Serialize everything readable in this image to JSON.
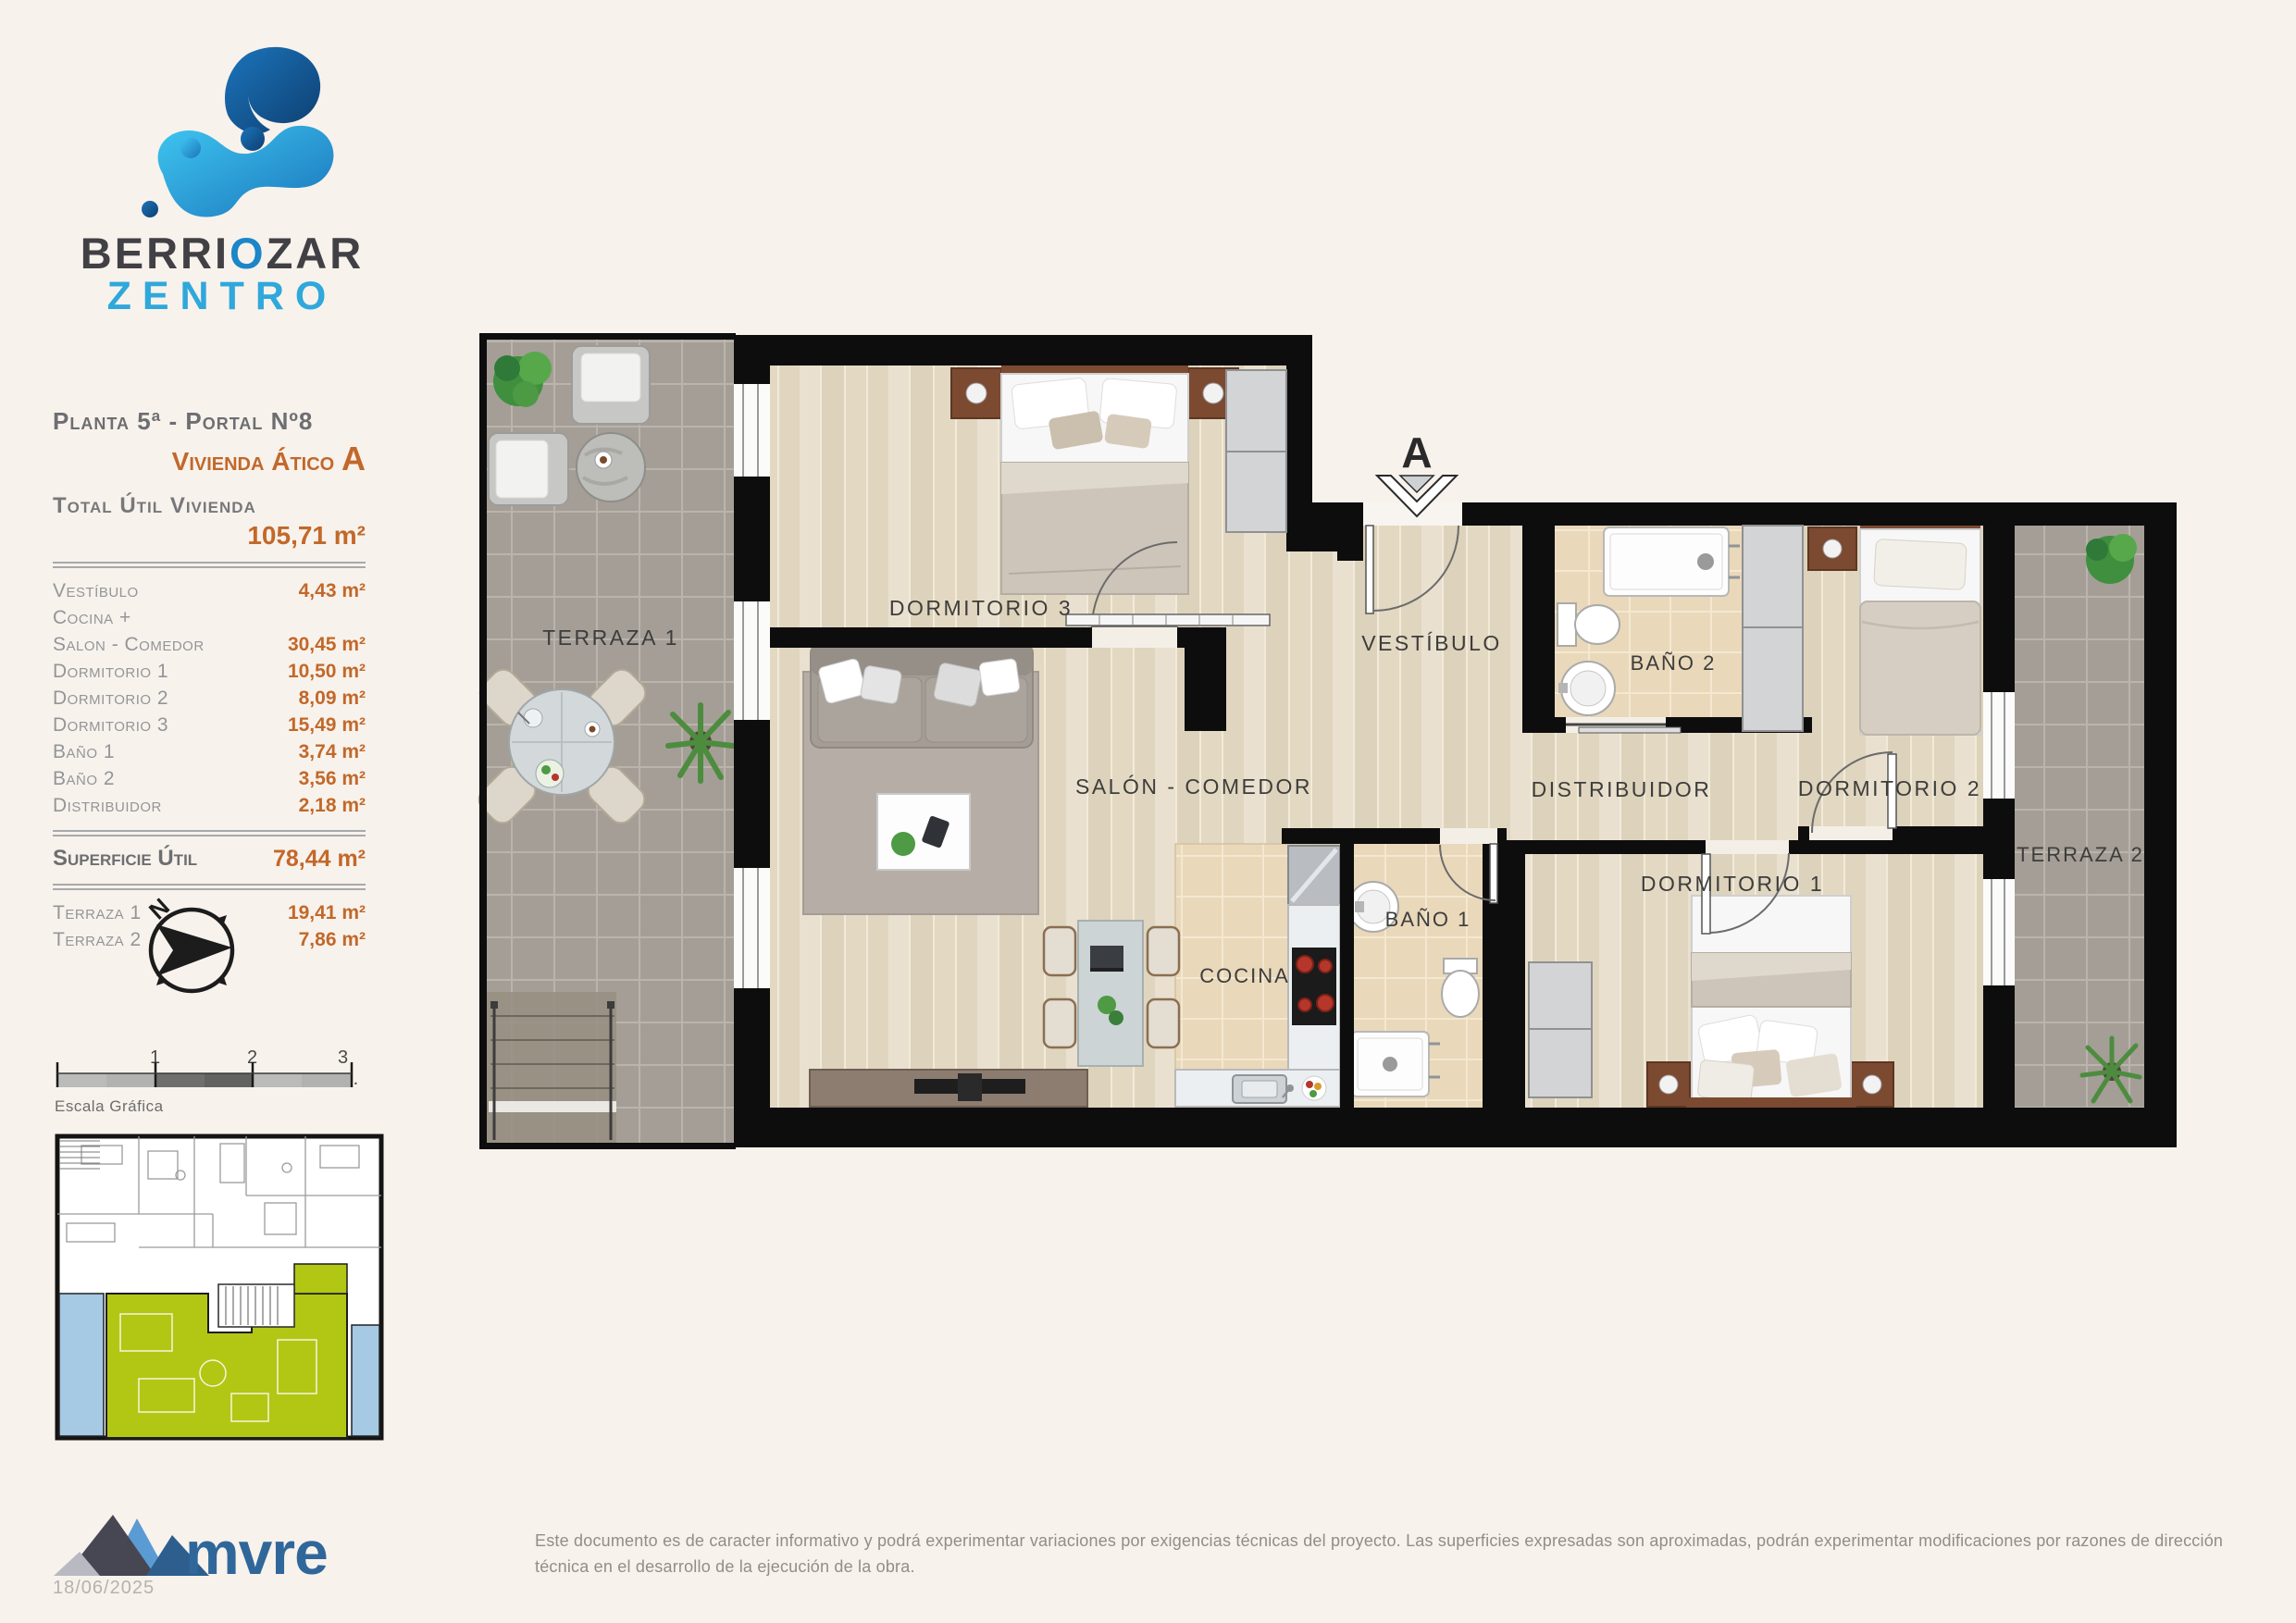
{
  "logo": {
    "line1_pre": "BERRI",
    "line1_o": "O",
    "line1_post": "ZAR",
    "line2": "ZENTRO"
  },
  "info": {
    "planta": "Planta 5ª - Portal Nº8",
    "vivienda": "Vivienda Ático ",
    "vivienda_letter": "A",
    "total_label": "Total Útil Vivienda",
    "total_value": "105,71 m²",
    "rows": [
      {
        "label": "Vestíbulo",
        "value": "4,43 m²"
      },
      {
        "label": "Cocina +",
        "value": ""
      },
      {
        "label": "Salon - Comedor",
        "value": "30,45 m²"
      },
      {
        "label": "Dormitorio 1",
        "value": "10,50 m²"
      },
      {
        "label": "Dormitorio 2",
        "value": "8,09 m²"
      },
      {
        "label": "Dormitorio 3",
        "value": "15,49 m²"
      },
      {
        "label": "Baño 1",
        "value": "3,74 m²"
      },
      {
        "label": "Baño 2",
        "value": "3,56 m²"
      },
      {
        "label": "Distribuidor",
        "value": "2,18 m²"
      }
    ],
    "superficie_label": "Superficie Útil",
    "superficie_value": "78,44 m²",
    "terrace_rows": [
      {
        "label": "Terraza 1",
        "value": "19,41 m²"
      },
      {
        "label": "Terraza 2",
        "value": "7,86 m²"
      }
    ]
  },
  "compass": {
    "letter": "N"
  },
  "scale": {
    "t1": "1",
    "t2": "2",
    "t3": "3 m.",
    "label": "Escala Gráfica"
  },
  "plan": {
    "marker": "A",
    "labels": [
      {
        "text": "TERRAZA 1"
      },
      {
        "text": "DORMITORIO 3"
      },
      {
        "text": "VESTÍBULO"
      },
      {
        "text": "BAÑO 2"
      },
      {
        "text": "DORMITORIO 2"
      },
      {
        "text": "SALÓN - COMEDOR"
      },
      {
        "text": "DISTRIBUIDOR"
      },
      {
        "text": "TERRAZA 2"
      },
      {
        "text": "DORMITORIO 1"
      },
      {
        "text": "COCINA"
      },
      {
        "text": "BAÑO 1"
      }
    ]
  },
  "footer": {
    "brand": "mvre",
    "date": "18/06/2025",
    "disclaimer": "Este documento es de caracter informativo y podrá experimentar variaciones por exigencias técnicas del proyecto. Las superficies expresadas son aproximadas, podrán experimentar modificaciones por razones de dirección técnica en el desarrollo de la ejecución de la obra."
  },
  "colors": {
    "accent_orange": "#c2682a",
    "brand_blue_light": "#2fa8db",
    "brand_blue_dark": "#1b75bc",
    "mvre_blue": "#30679b",
    "plan_green": "#b2c614",
    "plan_blue": "#a6c9e4",
    "wall_black": "#0d0d0d",
    "background": "#f8f2ec"
  }
}
